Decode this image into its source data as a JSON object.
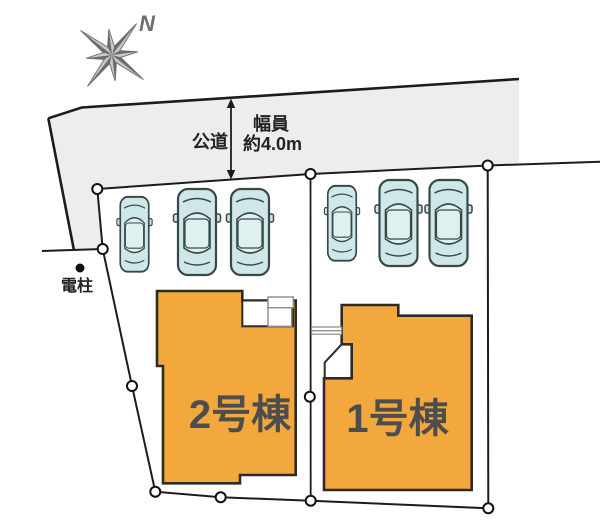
{
  "diagram": {
    "type": "real-estate-site-plan",
    "compass": {
      "label": "N"
    },
    "road": {
      "name": "公道",
      "width_label": "幅員",
      "width_value": "約4.0m"
    },
    "landmarks": {
      "utility_pole": "電柱"
    },
    "lots": [
      {
        "building_label": "2号棟",
        "parked_cars": 3
      },
      {
        "building_label": "1号棟",
        "parked_cars": 3
      }
    ],
    "icons": {
      "compass": "compass-rose-icon",
      "car": "car-top-view-icon",
      "boundary_marker": "boundary-point-marker",
      "pole": "utility-pole-dot"
    },
    "colors": {
      "road": "#ededed",
      "building": "#F2A83C",
      "building_outline": "#2E2A25",
      "boundary_line": "#1C1C1C",
      "car_body": "#CFE7E8",
      "car_cabin": "#DFF0F0",
      "compass_gray": "#C9C9C9",
      "compass_dark": "#6B6B6B",
      "label_text": "#4D4D4D"
    }
  }
}
